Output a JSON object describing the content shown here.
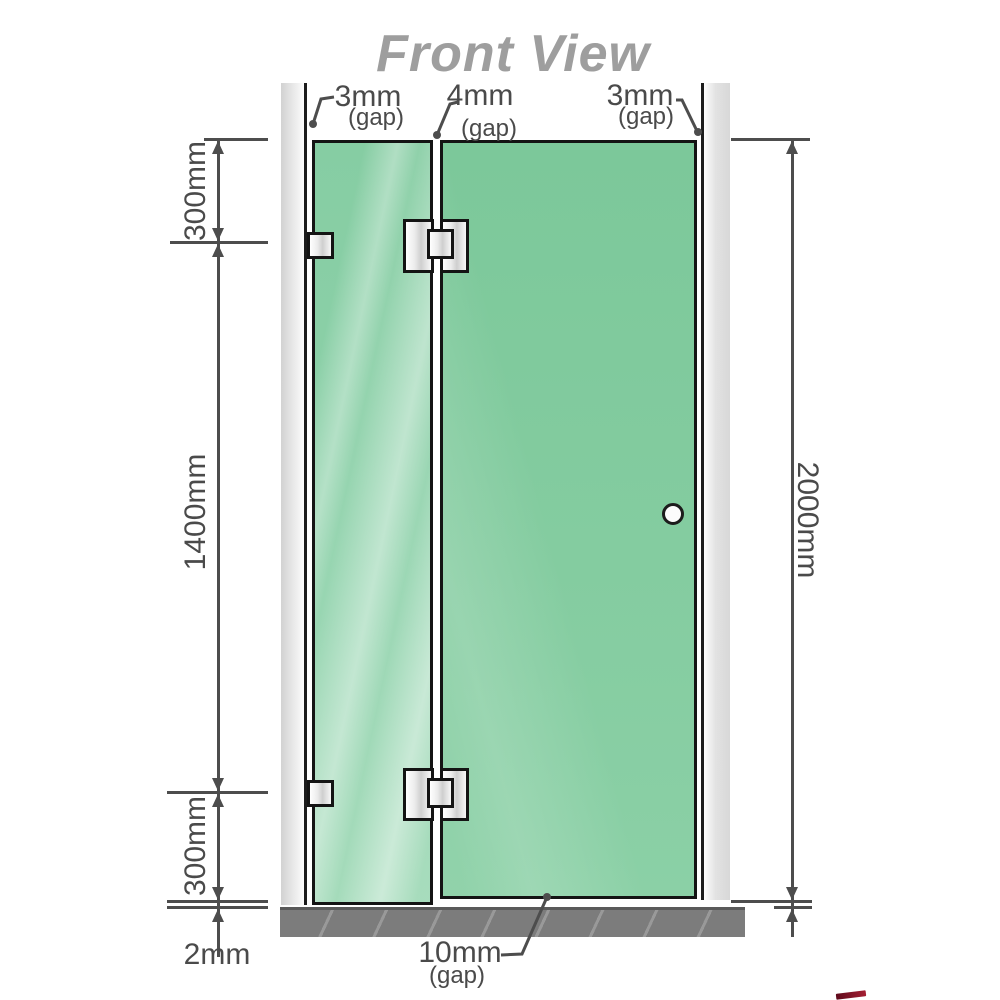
{
  "title": "Front View",
  "gaps": {
    "top": [
      {
        "value": "3mm",
        "note": "(gap)"
      },
      {
        "value": "4mm",
        "note": "(gap)"
      },
      {
        "value": "3mm",
        "note": "(gap)"
      }
    ],
    "bottom": {
      "value": "10mm",
      "note": "(gap)"
    }
  },
  "dims": {
    "left": {
      "upper": "300mm",
      "middle": "1400mm",
      "lower": "300mm",
      "floor": "2mm"
    },
    "right": {
      "total": "2000mm"
    }
  },
  "colors": {
    "glass_green": "#84cba0",
    "glass_green_light": "#b9e4cb",
    "wall_gray": "#d7d7d7",
    "wall_edge_black": "#1c1c1c",
    "floor_gray": "#7c7c7c",
    "dimension_gray": "#4d4d4d",
    "title_gray": "#9e9e9e",
    "metal_silver": "#d9d9d9",
    "accent_red": "#a41f33"
  }
}
